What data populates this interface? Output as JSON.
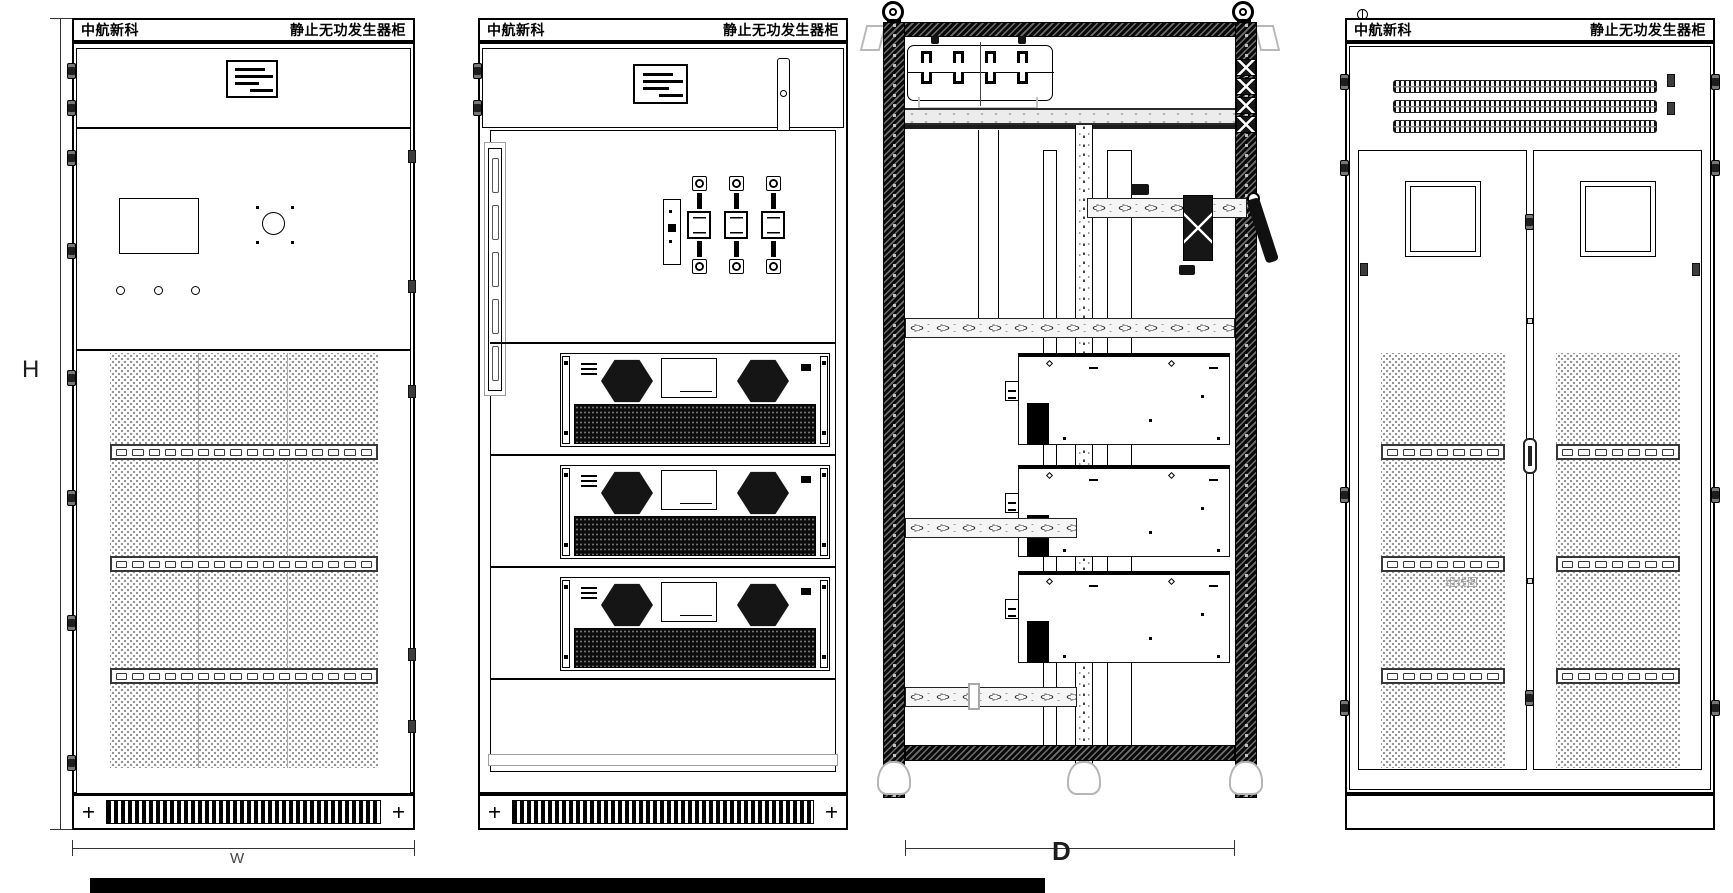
{
  "titles": {
    "company": "中航新科",
    "product": "静止无功发生器柜"
  },
  "dimensions": {
    "height": "H",
    "width": "W",
    "depth": "D"
  },
  "rear_view": {
    "note": "组线图"
  }
}
